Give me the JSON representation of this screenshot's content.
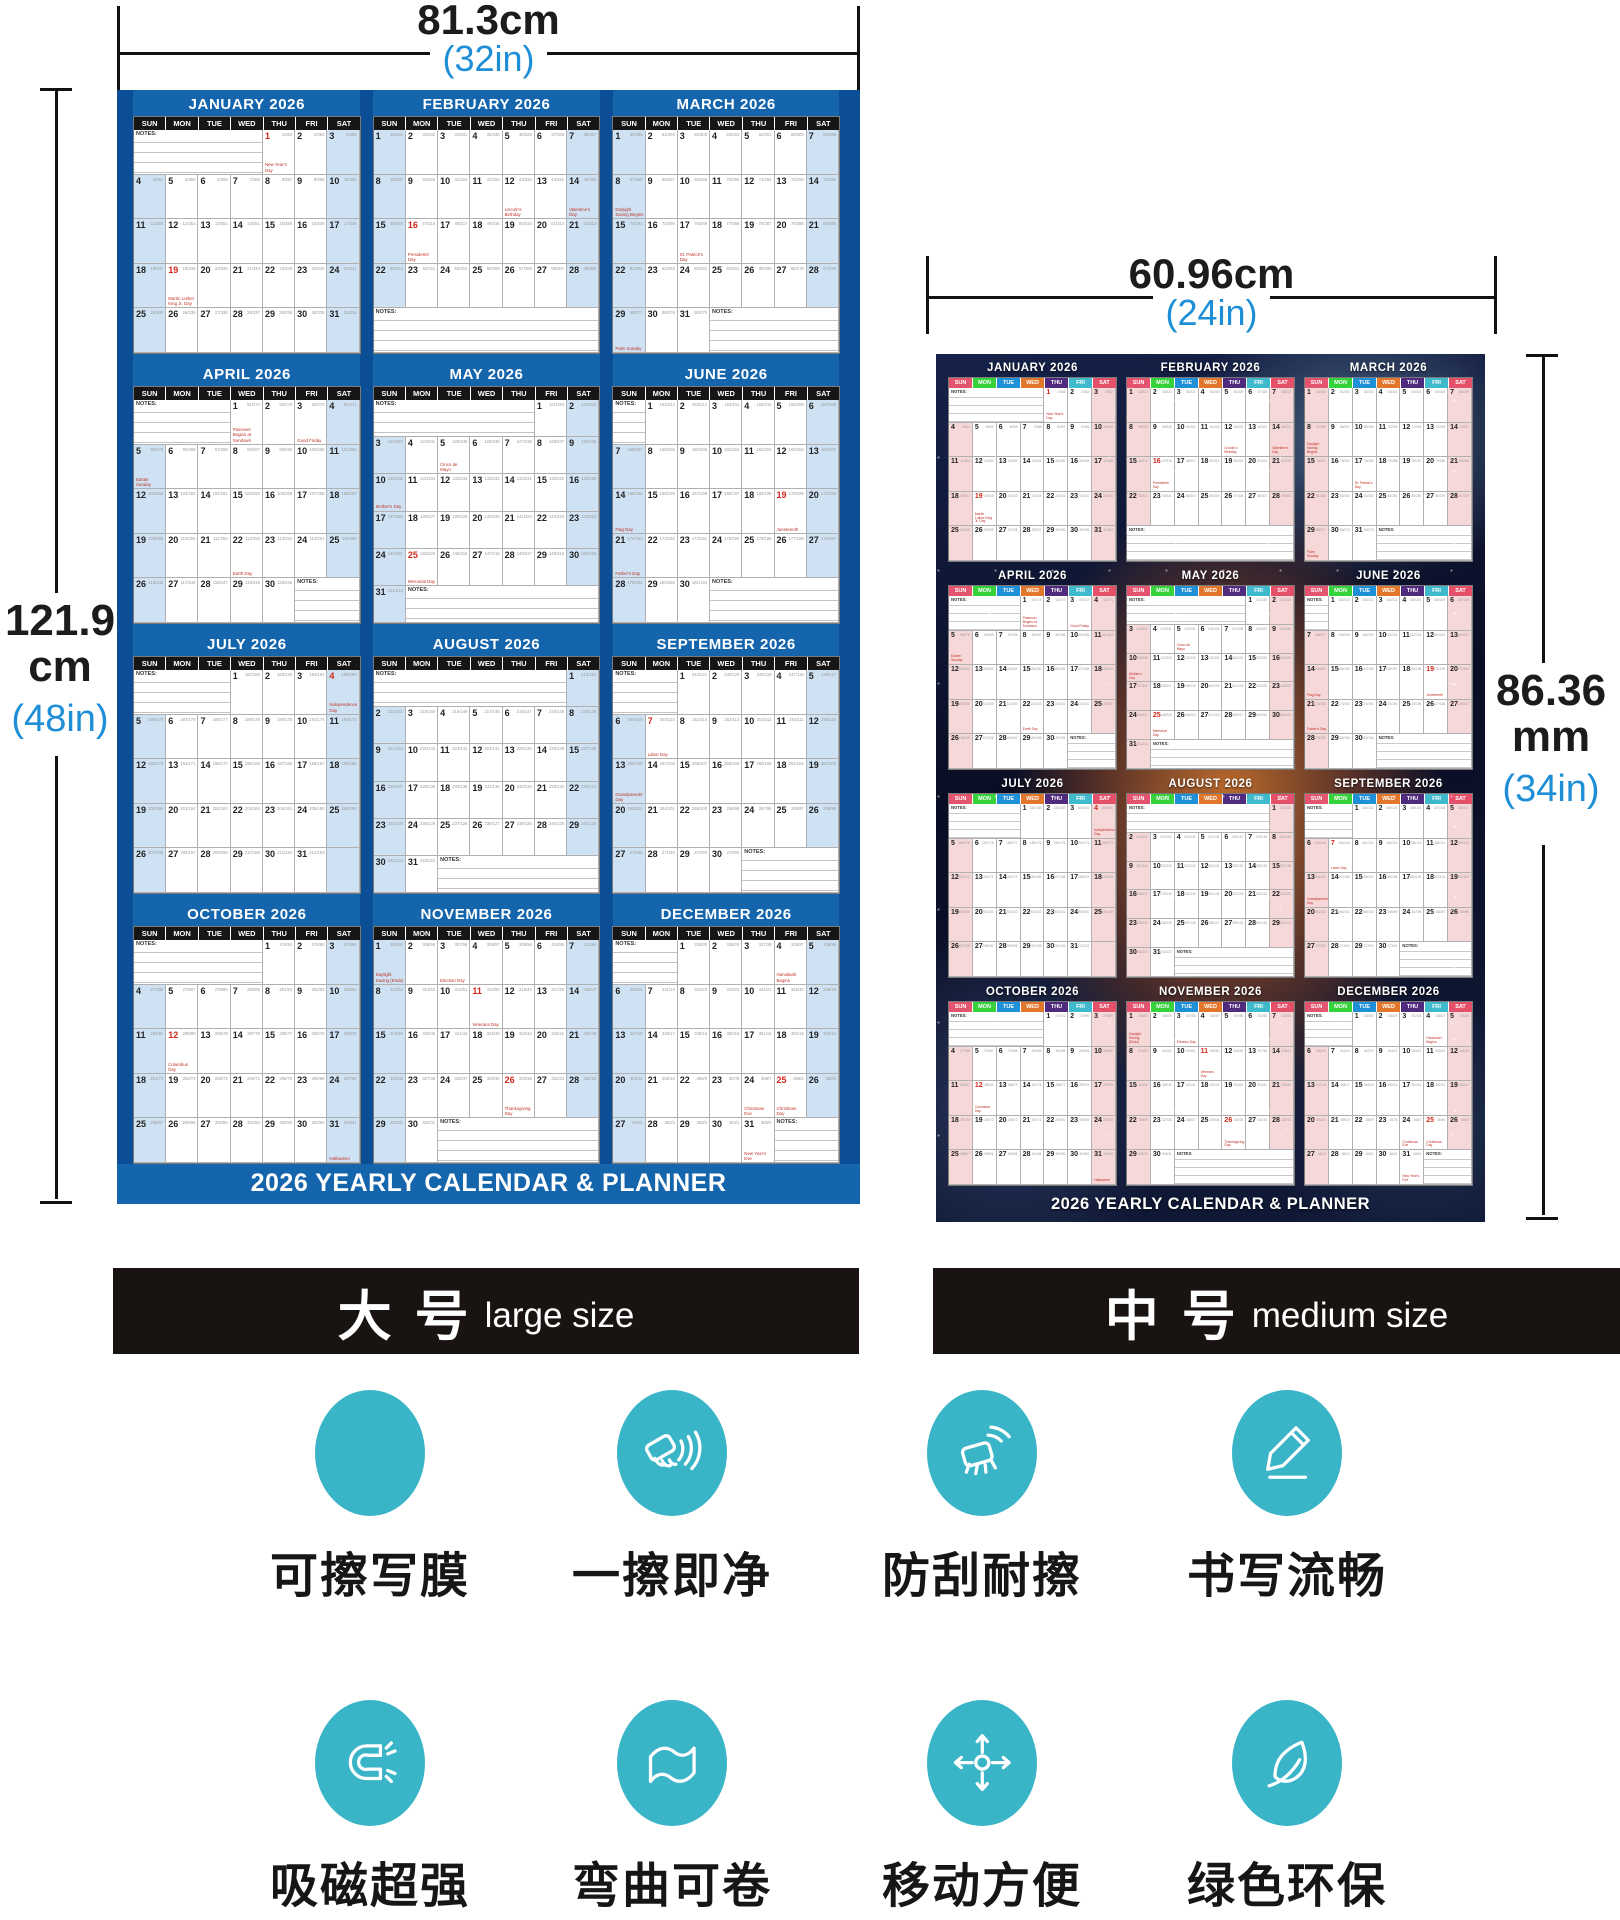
{
  "dimensions": {
    "large_width": {
      "value": "81.3cm",
      "inches": "(32in)"
    },
    "large_height": {
      "value": "121.9",
      "unit": "cm",
      "inches": "(48in)"
    },
    "medium_width": {
      "value": "60.96cm",
      "inches": "(24in)"
    },
    "medium_height": {
      "value": "86.36",
      "unit": "mm",
      "inches": "(34in)"
    }
  },
  "banners": [
    {
      "cn": "大 号",
      "en": "large size"
    },
    {
      "cn": "中 号",
      "en": "medium size"
    }
  ],
  "features": [
    {
      "icon": "erasable-film-icon",
      "label": "可擦写膜"
    },
    {
      "icon": "wipe-clean-icon",
      "label": "一擦即净"
    },
    {
      "icon": "scratch-resistant-icon",
      "label": "防刮耐擦"
    },
    {
      "icon": "smooth-writing-icon",
      "label": "书写流畅"
    },
    {
      "icon": "magnet-icon",
      "label": "吸磁超强"
    },
    {
      "icon": "bendable-icon",
      "label": "弯曲可卷"
    },
    {
      "icon": "portable-icon",
      "label": "移动方便"
    },
    {
      "icon": "eco-icon",
      "label": "绿色环保"
    }
  ],
  "calendar": {
    "year": "2026",
    "footer": "2026 YEARLY CALENDAR & PLANNER",
    "notes_label": "NOTES:",
    "day_headers": [
      "SUN",
      "MON",
      "TUE",
      "WED",
      "THU",
      "FRI",
      "SAT"
    ],
    "months": [
      {
        "name": "JANUARY 2026",
        "first_day": 4,
        "days": 31
      },
      {
        "name": "FEBRUARY 2026",
        "first_day": 0,
        "days": 28
      },
      {
        "name": "MARCH 2026",
        "first_day": 0,
        "days": 31
      },
      {
        "name": "APRIL 2026",
        "first_day": 3,
        "days": 30
      },
      {
        "name": "MAY 2026",
        "first_day": 5,
        "days": 31
      },
      {
        "name": "JUNE 2026",
        "first_day": 1,
        "days": 30
      },
      {
        "name": "JULY 2026",
        "first_day": 3,
        "days": 31
      },
      {
        "name": "AUGUST 2026",
        "first_day": 6,
        "days": 31
      },
      {
        "name": "SEPTEMBER 2026",
        "first_day": 2,
        "days": 30
      },
      {
        "name": "OCTOBER 2026",
        "first_day": 4,
        "days": 31
      },
      {
        "name": "NOVEMBER 2026",
        "first_day": 0,
        "days": 30
      },
      {
        "name": "DECEMBER 2026",
        "first_day": 2,
        "days": 31
      }
    ],
    "holidays": [
      {
        "m": 1,
        "d": 1,
        "label": "New Year's Day",
        "red": true
      },
      {
        "m": 1,
        "d": 19,
        "label": "Martin Luther King Jr. Day",
        "red": true
      },
      {
        "m": 2,
        "d": 12,
        "label": "Lincoln's Birthday",
        "red": false
      },
      {
        "m": 2,
        "d": 14,
        "label": "Valentine's Day",
        "red": false
      },
      {
        "m": 2,
        "d": 16,
        "label": "Presidents' Day",
        "red": true
      },
      {
        "m": 3,
        "d": 8,
        "label": "Daylight Saving Begins",
        "red": false
      },
      {
        "m": 3,
        "d": 17,
        "label": "St. Patrick's Day",
        "red": false
      },
      {
        "m": 3,
        "d": 29,
        "label": "Palm Sunday",
        "red": false
      },
      {
        "m": 4,
        "d": 1,
        "label": "Passover Begins at Sundown",
        "red": false
      },
      {
        "m": 4,
        "d": 3,
        "label": "Good Friday",
        "red": false
      },
      {
        "m": 4,
        "d": 5,
        "label": "Easter Sunday",
        "red": false
      },
      {
        "m": 4,
        "d": 22,
        "label": "Earth Day",
        "red": false
      },
      {
        "m": 5,
        "d": 5,
        "label": "Cinco de Mayo",
        "red": false
      },
      {
        "m": 5,
        "d": 10,
        "label": "Mother's Day",
        "red": false
      },
      {
        "m": 5,
        "d": 25,
        "label": "Memorial Day",
        "red": true
      },
      {
        "m": 6,
        "d": 14,
        "label": "Flag Day",
        "red": false
      },
      {
        "m": 6,
        "d": 19,
        "label": "Juneteenth",
        "red": true
      },
      {
        "m": 6,
        "d": 21,
        "label": "Father's Day",
        "red": false
      },
      {
        "m": 7,
        "d": 4,
        "label": "Independence Day",
        "red": true
      },
      {
        "m": 9,
        "d": 7,
        "label": "Labor Day",
        "red": true
      },
      {
        "m": 9,
        "d": 13,
        "label": "Grandparents' Day",
        "red": false
      },
      {
        "m": 10,
        "d": 12,
        "label": "Columbus Day",
        "red": true
      },
      {
        "m": 10,
        "d": 31,
        "label": "Halloween",
        "red": false
      },
      {
        "m": 11,
        "d": 1,
        "label": "Daylight Saving (Ends)",
        "red": false
      },
      {
        "m": 11,
        "d": 3,
        "label": "Election Day",
        "red": false
      },
      {
        "m": 11,
        "d": 11,
        "label": "Veterans Day",
        "red": true
      },
      {
        "m": 11,
        "d": 26,
        "label": "Thanksgiving Day",
        "red": true
      },
      {
        "m": 12,
        "d": 4,
        "label": "Hanukkah Begins",
        "red": false
      },
      {
        "m": 12,
        "d": 24,
        "label": "Christmas Eve",
        "red": false
      },
      {
        "m": 12,
        "d": 25,
        "label": "Christmas Day",
        "red": true
      },
      {
        "m": 12,
        "d": 31,
        "label": "New Year's Eve",
        "red": false
      }
    ]
  },
  "theme": {
    "poster_blue": "#1565ad",
    "gutter_blue": "#0b4e96",
    "weekend_blue": "#cfe2f3",
    "weekend_pink": "#f7d8d8",
    "accent_text_blue": "#1e8fd6",
    "icon_teal": "#3ab4c7",
    "medium_dow_colors": [
      "#e4546e",
      "#35d23c",
      "#1f8fd8",
      "#e2762a",
      "#4f2a7f",
      "#41b9cd",
      "#e4506a"
    ]
  }
}
